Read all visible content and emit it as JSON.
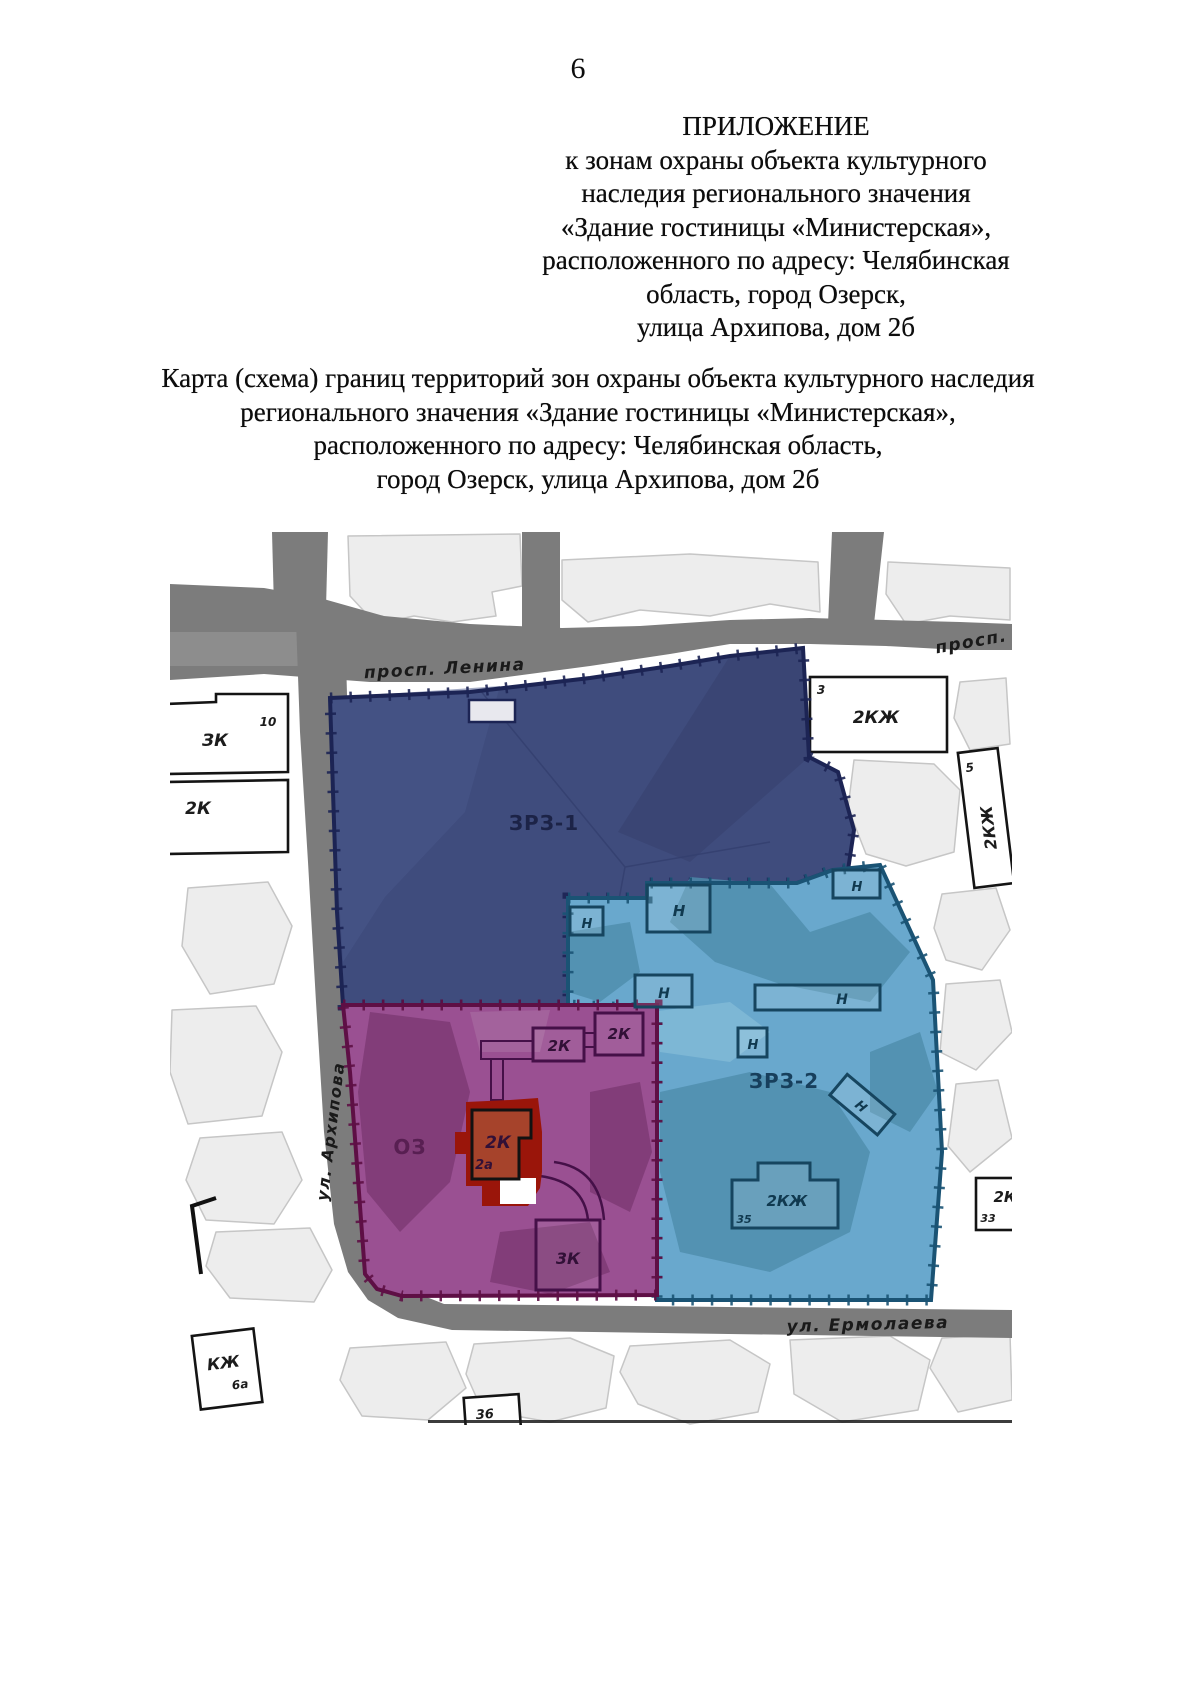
{
  "page": {
    "number": "6"
  },
  "appendix": {
    "lines": [
      "ПРИЛОЖЕНИЕ",
      "к зонам охраны объекта культурного",
      "наследия регионального значения",
      "«Здание гостиницы «Министерская»,",
      "расположенного по адресу: Челябинская",
      "область, город Озерск,",
      "улица Архипова, дом 2б"
    ]
  },
  "caption": {
    "lines": [
      "Карта (схема) границ территорий зон охраны объекта культурного наследия",
      "регионального значения «Здание гостиницы «Министерская»,",
      "расположенного по адресу: Челябинская область,",
      "город Озерск, улица Архипова, дом 2б"
    ]
  },
  "map": {
    "streets": {
      "lenina": "просп. Ленина",
      "lenina_right": "просп. Ле",
      "arkhipova": "ул. Архипова",
      "ermolaeva": "ул. Ермолаева"
    },
    "zones": {
      "zrz1": "ЗРЗ-1",
      "zrz2": "ЗРЗ-2",
      "oz": "ОЗ"
    },
    "heritage_object": {
      "storeys": "2К",
      "house_number": "2а"
    },
    "buildings": {
      "b3k_left": "ЗК",
      "b3k_left_num": "10",
      "b2k_left": "2К",
      "b2kzh_top": "2КЖ",
      "b2kzh_top_num": "3",
      "b2kzh_right": "2КЖ",
      "b2kzh_right_num": "5",
      "n1": "Н",
      "n2": "Н",
      "n3": "Н",
      "n4": "Н",
      "n5": "Н",
      "n6": "Н",
      "n7": "Н",
      "b2k_a": "2К",
      "b2k_b": "2К",
      "b3k_purple": "3К",
      "b2kzh_35": "2КЖ",
      "b2kzh_35_num": "35",
      "b2kzh_33": "2КЖ",
      "b2kzh_33_num": "33",
      "bkzh": "КЖ",
      "bkzh_num": "6а",
      "bkzh36_num": "36",
      "bkzh36": "КЖ"
    },
    "colors": {
      "zone1_fill": "#3f4c7d",
      "zone1_border": "#1c2454",
      "zone2_fill": "#69a8cd",
      "zone2_border": "#1a5374",
      "zone3_fill": "#9a5092",
      "zone3_border": "#5e0f45",
      "object_fill": "#a6432b",
      "object_border": "#9a150a",
      "road": "#7c7c7c"
    }
  }
}
